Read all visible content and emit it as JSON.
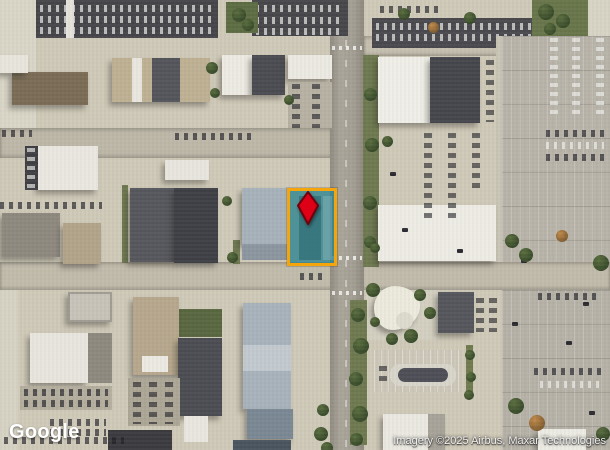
{
  "branding": {
    "logo_text": "Google"
  },
  "attribution": {
    "text": "Imagery ©2025 Airbus, Maxar Technologies"
  },
  "highlight": {
    "parcel_border_color": "#f3a50b",
    "parcel_fill_color": "rgba(46,133,144,0.8)",
    "marker_fill": "#dd0017",
    "marker_stroke": "#70000c"
  }
}
